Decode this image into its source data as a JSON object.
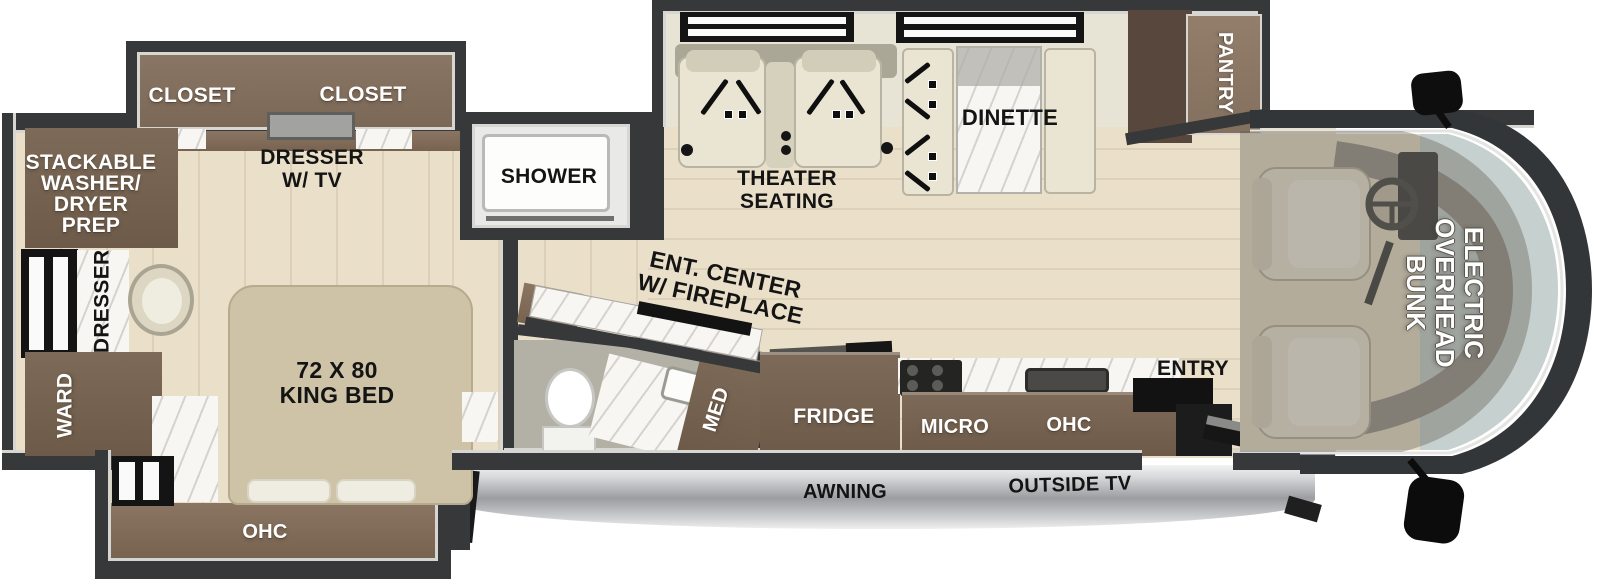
{
  "plan_title": "RV floor plan",
  "colors": {
    "wall": "#36383a",
    "floor": "#eadfc9",
    "cabinet": "#7d6a58",
    "cabinet_dark": "#57473d",
    "marble": "#f7f6f2",
    "seat_cream": "#e9e5d2",
    "windshield": "#c6d0ce",
    "awning_silver": "#c7c8ca",
    "label_white": "#ffffff",
    "label_black": "#141414"
  },
  "labels": {
    "closet_left": "CLOSET",
    "closet_right": "CLOSET",
    "dresser_tv": [
      "DRESSER",
      "W/ TV"
    ],
    "washer_prep": [
      "STACKABLE",
      "WASHER/",
      "DRYER",
      "PREP"
    ],
    "dresser_side": "DRESSER",
    "ward": "WARD",
    "king_bed": [
      "72 X 80",
      "KING BED"
    ],
    "bedroom_ohc": "OHC",
    "shower": "SHOWER",
    "ent_center": [
      "ENT. CENTER",
      "W/ FIREPLACE"
    ],
    "med": "MED",
    "theater_seating": [
      "THEATER",
      "SEATING"
    ],
    "dinette": "DINETTE",
    "pantry": "PANTRY",
    "fridge": "FRIDGE",
    "micro": "MICRO",
    "kitchen_ohc": "OHC",
    "entry": "ENTRY",
    "awning": "AWNING",
    "outside_tv": "OUTSIDE TV",
    "overhead_bunk": [
      "ELECTRIC",
      "OVERHEAD",
      "BUNK"
    ]
  }
}
